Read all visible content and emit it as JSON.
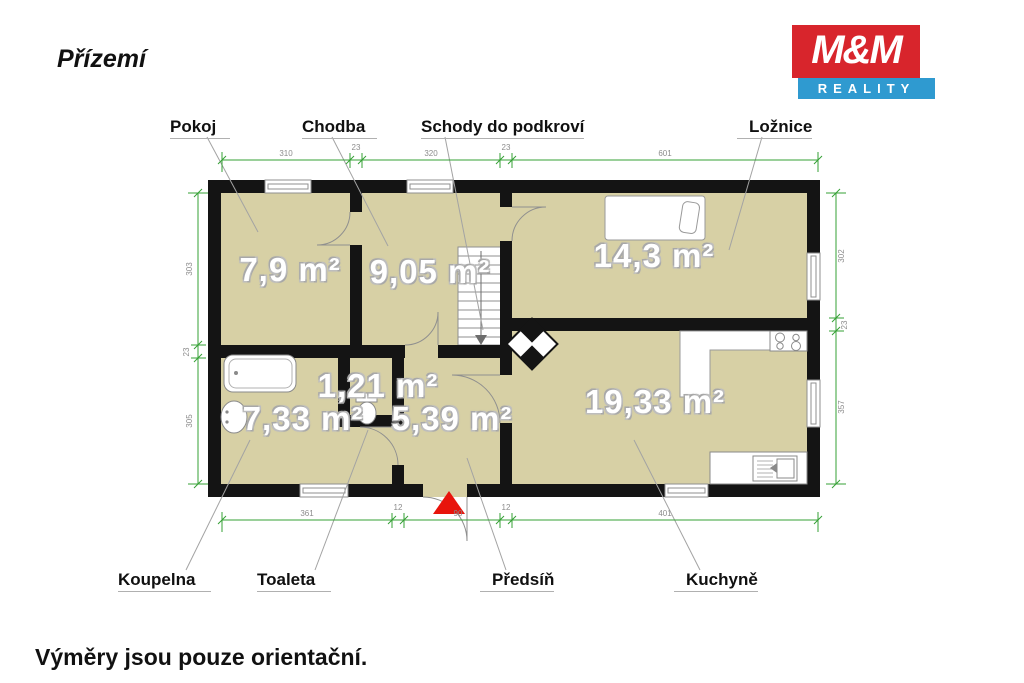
{
  "page": {
    "title": "Přízemí",
    "footer": "Výměry jsou pouze orientační."
  },
  "logo": {
    "line1": "M&M",
    "line2": "REALITY",
    "red": "#d8252c",
    "blue": "#2f9ad0"
  },
  "rooms": {
    "pokoj": {
      "label": "Pokoj",
      "area": "7,9 m²"
    },
    "chodba": {
      "label": "Chodba",
      "area": "9,05 m²"
    },
    "schody": {
      "label": "Schody do podkroví"
    },
    "loznice": {
      "label": "Ložnice",
      "area": "14,3 m²"
    },
    "koupelna": {
      "label": "Koupelna",
      "area": "7,33 m²"
    },
    "toaleta": {
      "label": "Toaleta",
      "area": "1,21 m²"
    },
    "predsin": {
      "label": "Předsíň",
      "area": "5,39 m²"
    },
    "kuchyne": {
      "label": "Kuchyně",
      "area": "19,33 m²"
    }
  },
  "dimensions": {
    "top": [
      "310",
      "23",
      "320",
      "23",
      "601"
    ],
    "bottom": [
      "361",
      "12",
      "90",
      "12",
      "401"
    ],
    "left": [
      "303",
      "23",
      "305"
    ],
    "right": [
      "302",
      "23",
      "357"
    ]
  },
  "colors": {
    "floor": "#d7d0a5",
    "wall": "#141414",
    "dimension": "#35a035",
    "entrance_marker": "#e8140c"
  }
}
